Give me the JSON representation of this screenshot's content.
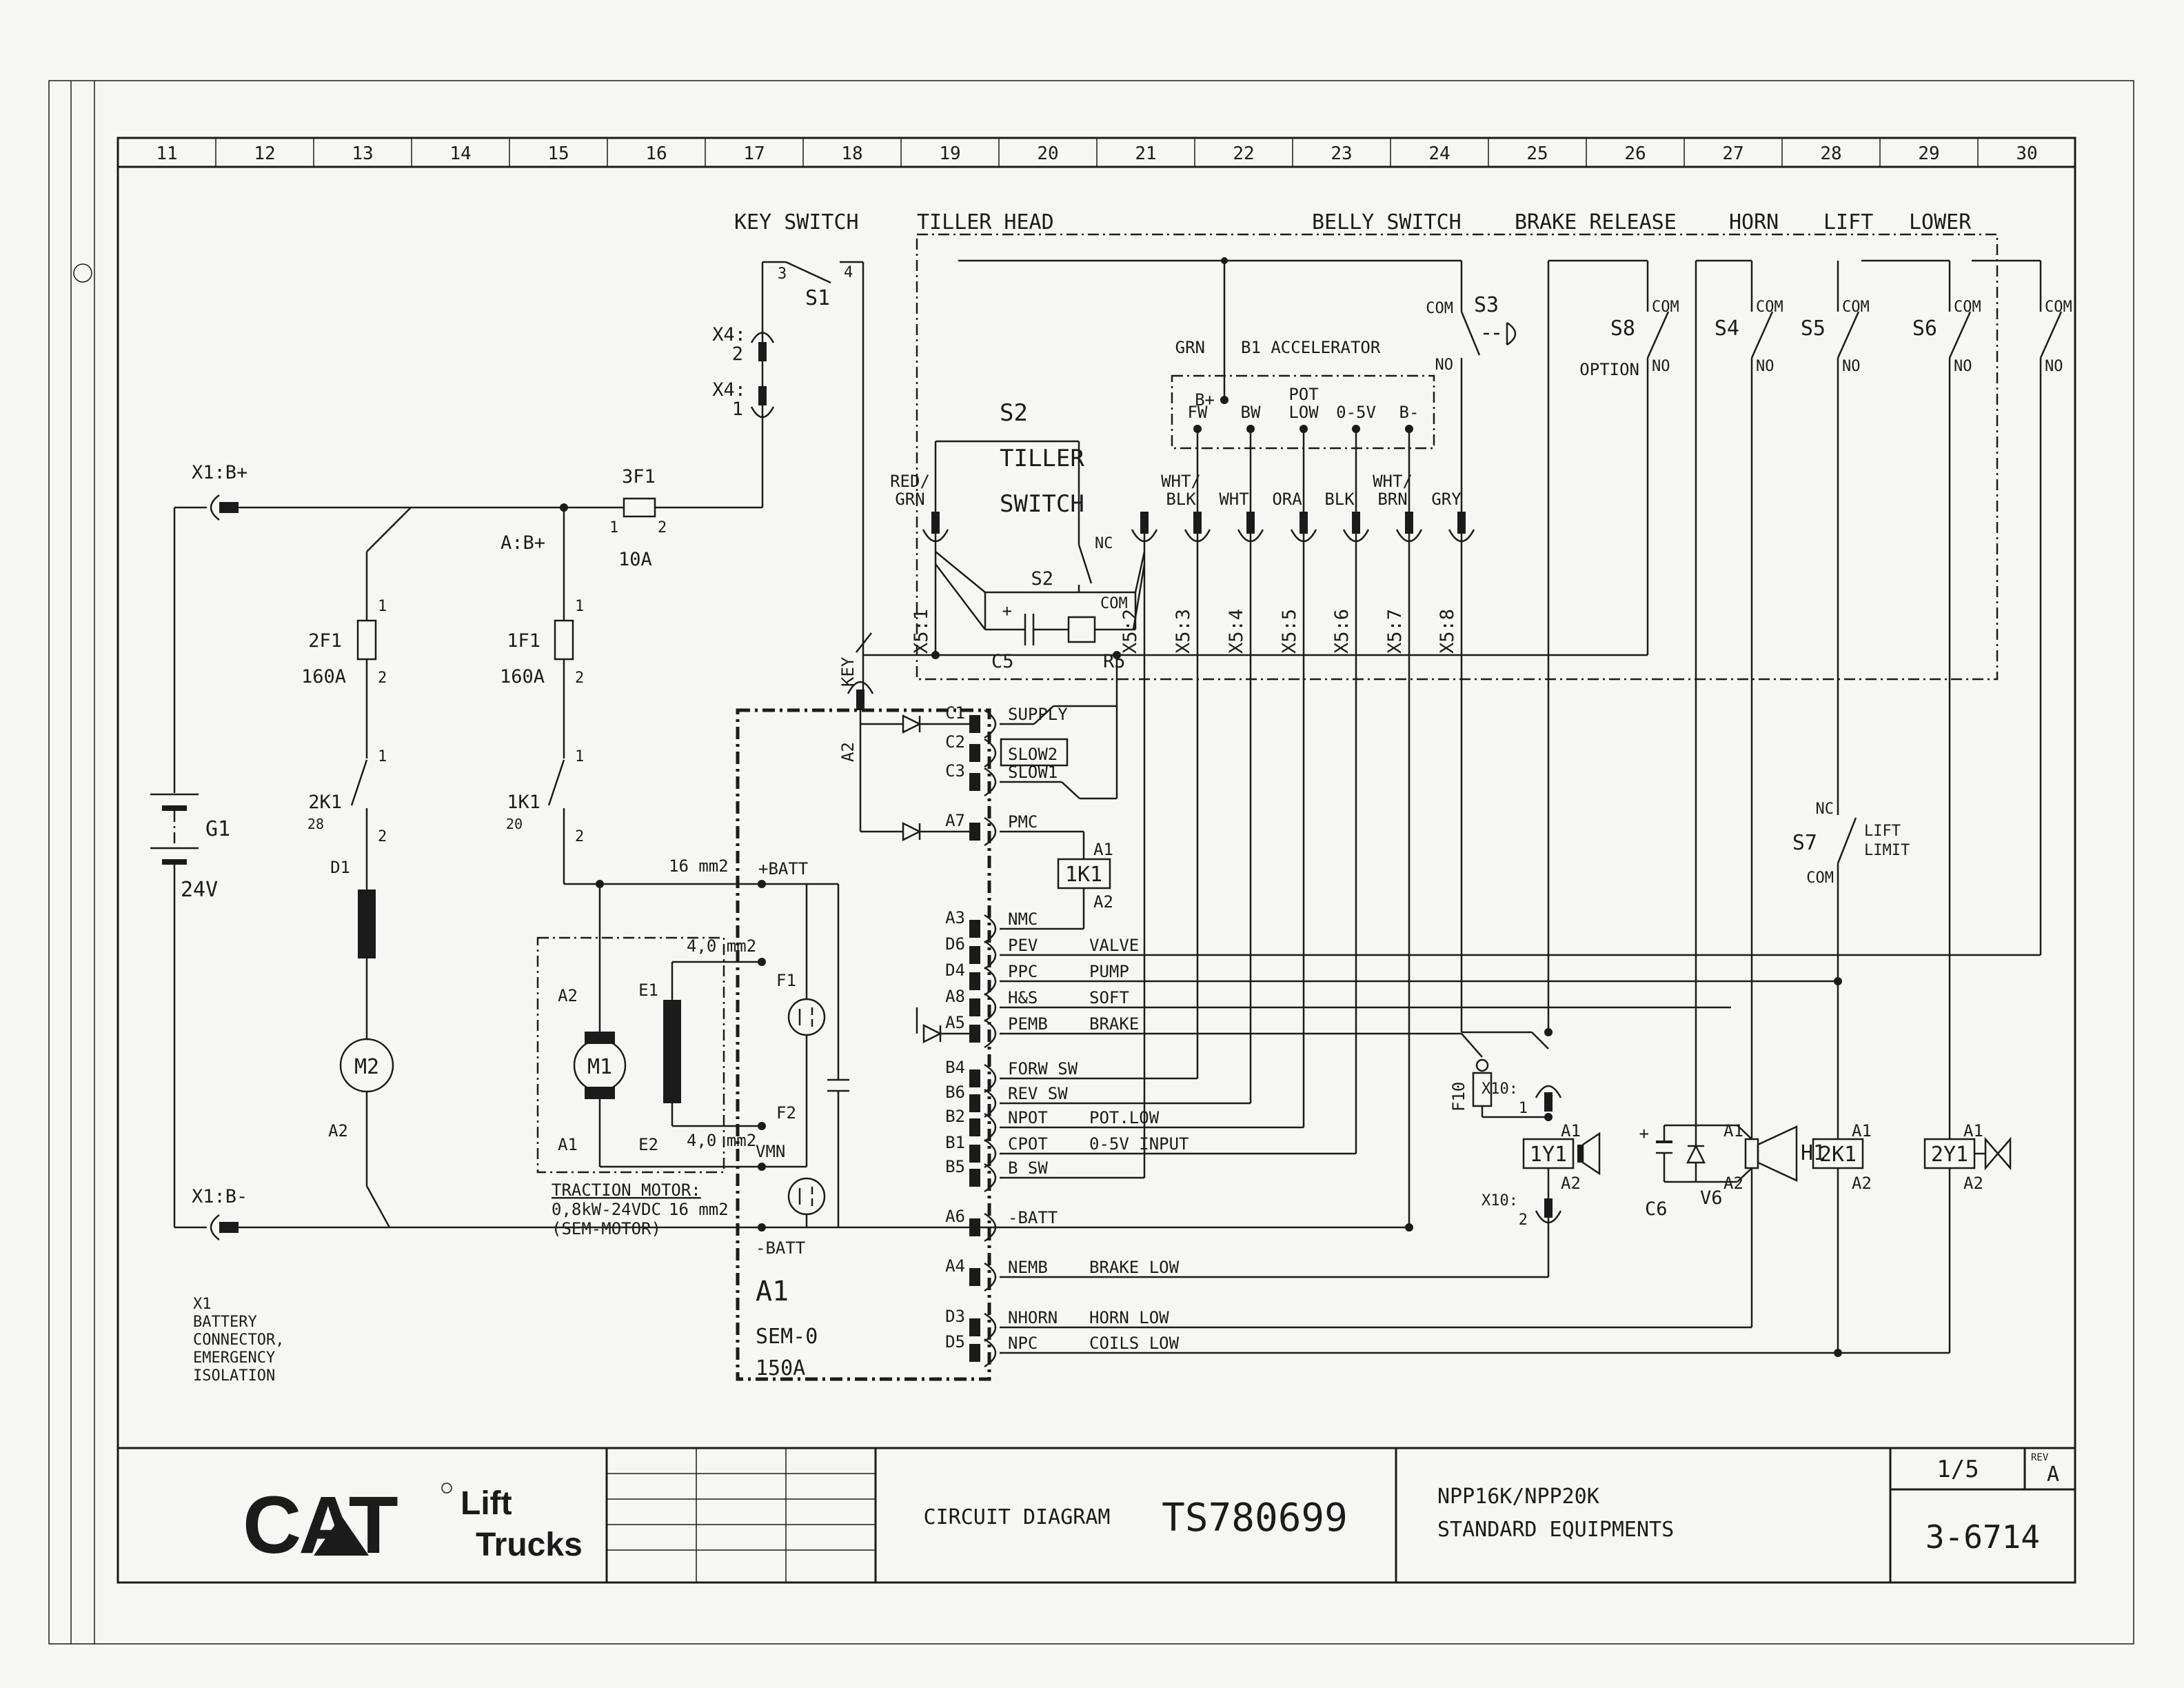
{
  "ruler": [
    "11",
    "12",
    "13",
    "14",
    "15",
    "16",
    "17",
    "18",
    "19",
    "20",
    "21",
    "22",
    "23",
    "24",
    "25",
    "26",
    "27",
    "28",
    "29",
    "30"
  ],
  "sections": {
    "key_switch": "KEY SWITCH",
    "tiller_head": "TILLER HEAD",
    "belly_switch": "BELLY SWITCH",
    "brake_release": "BRAKE RELEASE",
    "horn": "HORN",
    "lift": "LIFT",
    "lower": "LOWER"
  },
  "left": {
    "x1bp": "X1:B+",
    "x1bm": "X1:B-",
    "abp": "A:B+",
    "f3": "3F1",
    "f3r": "10A",
    "f2": "2F1",
    "f2r": "160A",
    "f1": "1F1",
    "f1r": "160A",
    "k2": "2K1",
    "k2n": "28",
    "k1": "1K1",
    "k1n": "20",
    "t1": "1",
    "t2": "2",
    "g1": "G1",
    "g1v": "24V",
    "d1": "D1",
    "m2": "M2",
    "m2t": "A2",
    "note1": "X1",
    "note2": "BATTERY",
    "note3": "CONNECTOR,",
    "note4": "EMERGENCY",
    "note5": "ISOLATION",
    "w16a": "16 mm2",
    "w16b": "16 mm2",
    "w4a": "4,0 mm2",
    "w4b": "4,0 mm2",
    "m1": "M1",
    "m1a2": "A2",
    "m1a1": "A1",
    "e1": "E1",
    "e2": "E2",
    "tm1": "TRACTION MOTOR:",
    "tm2": "0,8kW-24VDC",
    "tm3": "(SEM-MOTOR)"
  },
  "keysw": {
    "s1": "S1",
    "t3": "3",
    "t4": "4",
    "x4a": "X4:",
    "x4an": "2",
    "x4b": "X4:",
    "x4bn": "1"
  },
  "ctrl": {
    "name": "A1",
    "model": "SEM-0",
    "rating": "150A",
    "key": "KEY",
    "keya2": "A2",
    "batp": "+BATT",
    "batm": "-BATT",
    "f1": "F1",
    "f2": "F2",
    "vmn": "VMN",
    "k1": "1K1",
    "k1a1": "A1",
    "k1a2": "A2",
    "pins": [
      {
        "pin": "C1",
        "signal": "SUPPLY",
        "note": ""
      },
      {
        "pin": "C2",
        "signal": "SLOW2",
        "note": ""
      },
      {
        "pin": "C3",
        "signal": "SLOW1",
        "note": ""
      },
      {
        "pin": "A7",
        "signal": "PMC",
        "note": ""
      },
      {
        "pin": "A3",
        "signal": "NMC",
        "note": ""
      },
      {
        "pin": "D6",
        "signal": "PEV",
        "note": "VALVE"
      },
      {
        "pin": "D4",
        "signal": "PPC",
        "note": "PUMP"
      },
      {
        "pin": "A8",
        "signal": "H&S",
        "note": "SOFT"
      },
      {
        "pin": "A5",
        "signal": "PEMB",
        "note": "BRAKE"
      },
      {
        "pin": "B4",
        "signal": "FORW SW",
        "note": ""
      },
      {
        "pin": "B6",
        "signal": "REV SW",
        "note": ""
      },
      {
        "pin": "B2",
        "signal": "NPOT",
        "note": "POT.LOW"
      },
      {
        "pin": "B1",
        "signal": "CPOT",
        "note": "0-5V INPUT"
      },
      {
        "pin": "B5",
        "signal": "B SW",
        "note": ""
      },
      {
        "pin": "A6",
        "signal": "-BATT",
        "note": ""
      },
      {
        "pin": "A4",
        "signal": "NEMB",
        "note": "BRAKE LOW"
      },
      {
        "pin": "D3",
        "signal": "NHORN",
        "note": "HORN LOW"
      },
      {
        "pin": "D5",
        "signal": "NPC",
        "note": "COILS LOW"
      }
    ]
  },
  "tiller": {
    "s2a": "S2",
    "s2b": "TILLER",
    "s2c": "SWITCH",
    "s2": "S2",
    "nc": "NC",
    "com": "COM",
    "c5": "C5",
    "r5": "R5",
    "plus": "+",
    "x5": [
      "X5:1",
      "X5:2",
      "X5:3",
      "X5:4",
      "X5:5",
      "X5:6",
      "X5:7",
      "X5:8"
    ],
    "colors": {
      "c1a": "RED/",
      "c1b": "GRN",
      "c3a": "WHT/",
      "c3b": "BLK",
      "c4": "WHT",
      "c5": "ORA",
      "c6": "BLK",
      "c7a": "WHT/",
      "c7b": "BRN",
      "c8": "GRY"
    }
  },
  "accel": {
    "grn": "GRN",
    "name": "B1 ACCELERATOR",
    "bp": "B+",
    "fw": "FW",
    "bw": "BW",
    "pota": "POT",
    "potb": "LOW",
    "v05": "0-5V",
    "bm": "B-"
  },
  "sw": {
    "s3": "S3",
    "s3com": "COM",
    "s3no": "NO",
    "s8": "S8",
    "s8opt": "OPTION",
    "s8com": "COM",
    "s8no": "NO",
    "s4": "S4",
    "s4com": "COM",
    "s4no": "NO",
    "s5": "S5",
    "s5com": "COM",
    "s5no": "NO",
    "s6": "S6",
    "s6com": "COM",
    "s6no": "NO",
    "sxcom": "COM",
    "sxno": "NO",
    "s7": "S7",
    "s7nc": "NC",
    "s7com": "COM",
    "s7l1": "LIFT",
    "s7l2": "LIMIT"
  },
  "coils": {
    "f10": "F10",
    "x10a": "X10:",
    "x10an": "1",
    "x10b": "X10:",
    "x10bn": "2",
    "y1": "1Y1",
    "y1a1": "A1",
    "y1a2": "A2",
    "c6": "C6",
    "v6": "V6",
    "h1": "H1",
    "h1a1": "A1",
    "h1a2": "A2",
    "k2": "2K1",
    "k2a1": "A1",
    "k2a2": "A2",
    "y2": "2Y1",
    "y2a1": "A1",
    "y2a2": "A2"
  },
  "title": {
    "cat": "CAT",
    "lift": "Lift",
    "trucks": "Trucks",
    "doc": "CIRCUIT DIAGRAM",
    "num": "TS780699",
    "model": "NPP16K/NPP20K",
    "sub": "STANDARD EQUIPMENTS",
    "page": "1/5",
    "revl": "REV",
    "rev": "A",
    "code": "3-6714"
  }
}
